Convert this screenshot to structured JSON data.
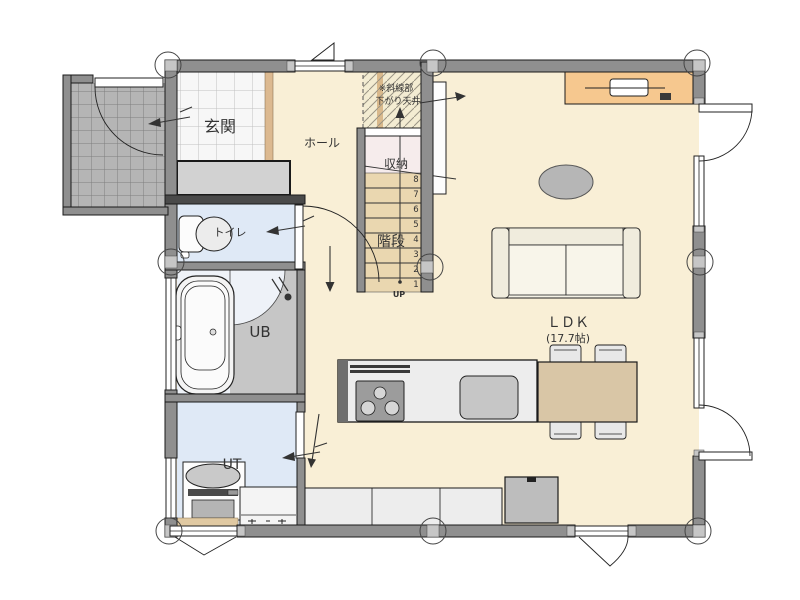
{
  "rooms": {
    "genkan": {
      "label": "玄関"
    },
    "hall": {
      "label": "ホール"
    },
    "toilet": {
      "label": "トイレ"
    },
    "bathroom": {
      "label": "UB"
    },
    "utility": {
      "label": "UT"
    },
    "storage": {
      "label": "収納"
    },
    "stairs": {
      "label": "階段",
      "up_label": "UP",
      "steps": [
        "1",
        "2",
        "3",
        "4",
        "5",
        "6",
        "7",
        "8"
      ]
    },
    "ldk": {
      "label": "ＬＤＫ",
      "size": "(17.7帖)"
    }
  },
  "notes": {
    "lowered_ceiling_line1": "※斜線部",
    "lowered_ceiling_line2": "下がり天井"
  },
  "colors": {
    "wall": "#8f8f8f",
    "dark_wall": "#4a4a4a",
    "wood_floor": "#f9efd6",
    "entry_tile": "#f7f7f7",
    "porch_tile": "#b5b5b5",
    "wet_floor": "#dfe9f6",
    "bath_floor": "#eef2f8",
    "stair_tread": "#ead7b0",
    "storage_floor": "#f6ecec",
    "lowered_ceiling_bg": "#f3ecd2",
    "counter_orange": "#f6c88f",
    "table_wood": "#d9c6a6",
    "agarikamachi": "#dcb990",
    "fixture_gray": "#c6c6c6"
  }
}
